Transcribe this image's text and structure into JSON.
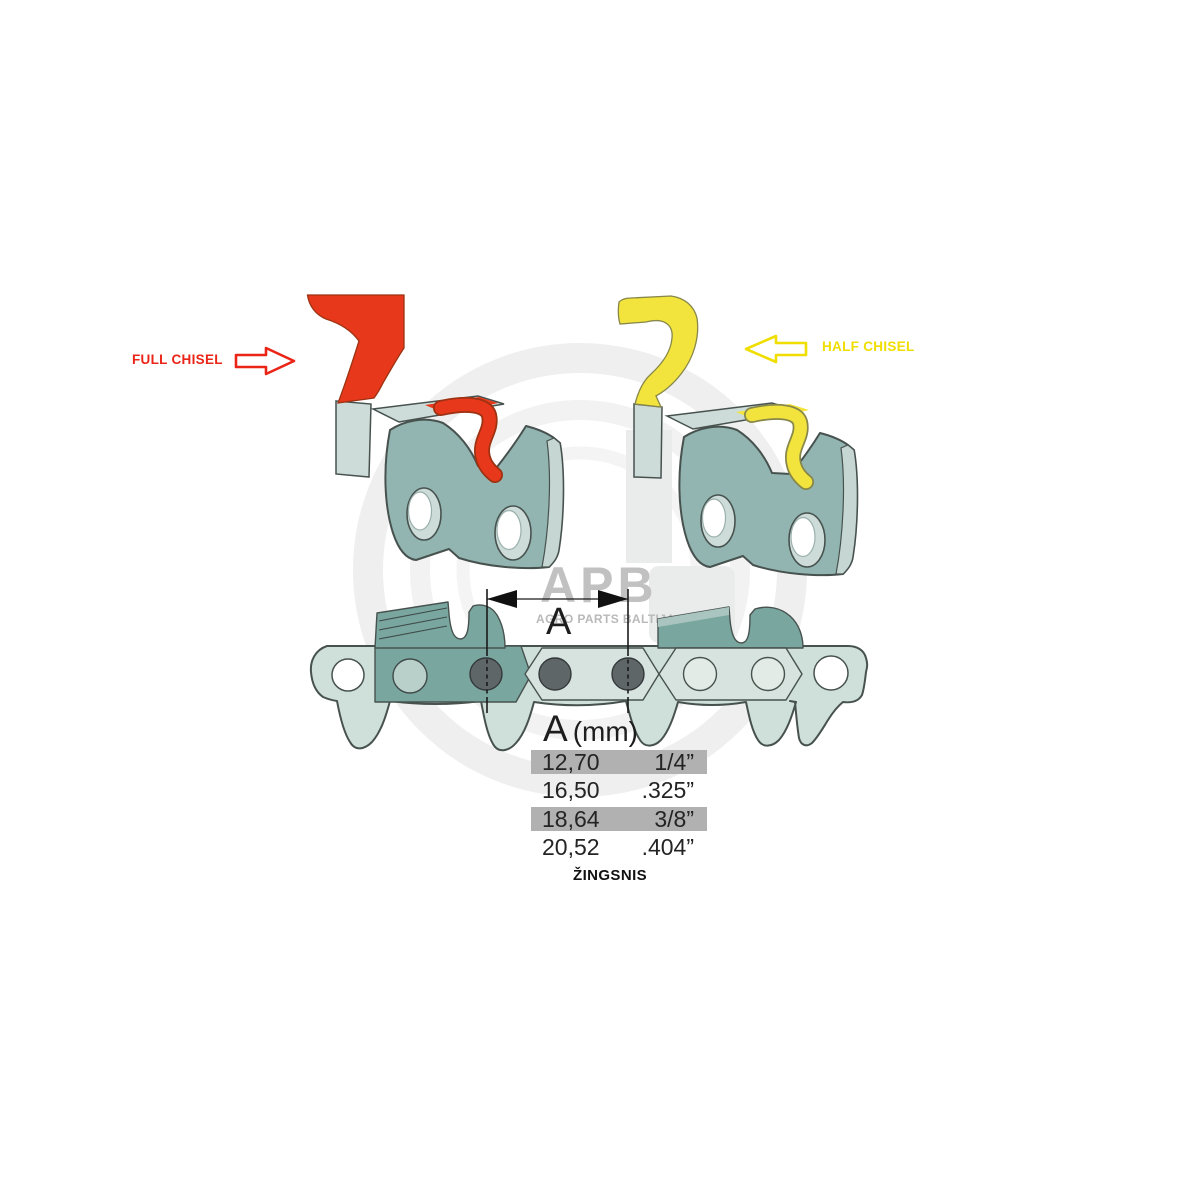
{
  "labels": {
    "full_chisel": "FULL CHISEL",
    "half_chisel": "HALF CHISEL",
    "dimension_a": "A"
  },
  "watermark": {
    "brand": "APB",
    "subtitle": "AGRO PARTS BALTIJA"
  },
  "pitch_table": {
    "header_letter": "A",
    "header_unit": "(mm)",
    "rows": [
      {
        "mm": "12,70",
        "inch": "1/4”",
        "highlighted": true
      },
      {
        "mm": "16,50",
        "inch": ".325”",
        "highlighted": false
      },
      {
        "mm": "18,64",
        "inch": "3/8”",
        "highlighted": true
      },
      {
        "mm": "20,52",
        "inch": ".404”",
        "highlighted": false
      }
    ],
    "caption": "ŽINGSNIS"
  },
  "colors": {
    "red": "#e8381b",
    "red-text": "#ea2517",
    "yellow": "#f2e43c",
    "yellow-accent": "#f0de00",
    "teal": "#93b5b1",
    "chain": "#cfdfd9",
    "chain-dark": "#7aa6a0",
    "rivet": "#5f6668",
    "table-gray": "#b1b1b1",
    "wm": "#c1c1c1",
    "ink": "#1d1d1d"
  }
}
